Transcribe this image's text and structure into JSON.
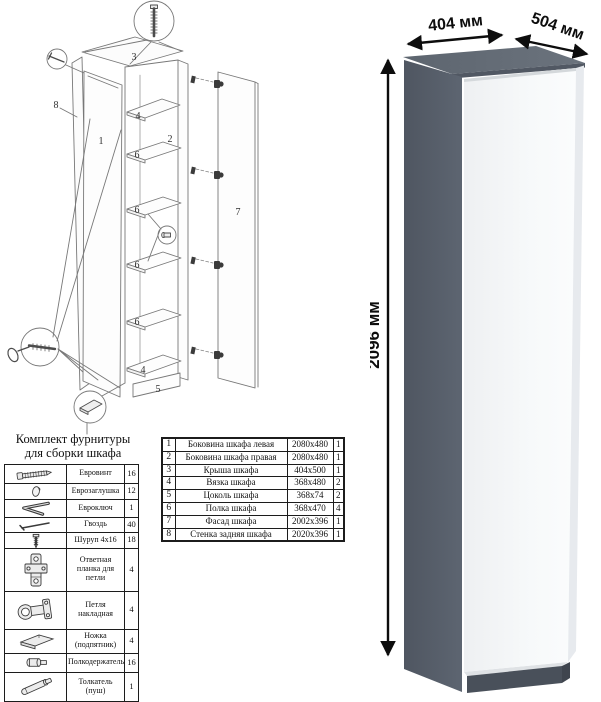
{
  "diagram": {
    "labels": {
      "left_side": "1",
      "right_side": "2",
      "roof": "3",
      "tie_top": "4",
      "tie_bottom": "4",
      "plinth": "5",
      "shelf_a": "6",
      "shelf_b": "6",
      "shelf_c": "6",
      "shelf_d": "6",
      "facade": "7",
      "back_panel": "8"
    }
  },
  "hardware": {
    "title_line1": "Комплект фурнитуры",
    "title_line2": "для сборки шкафа",
    "rows": [
      {
        "icon": "euroscrew-icon",
        "name": "Евровинт",
        "qty": "16"
      },
      {
        "icon": "eurocap-icon",
        "name": "Еврозаглушка",
        "qty": "12"
      },
      {
        "icon": "eurokey-icon",
        "name": "Евроключ",
        "qty": "1"
      },
      {
        "icon": "nail-icon",
        "name": "Гвоздь",
        "qty": "40"
      },
      {
        "icon": "screw-icon",
        "name": "Шуруп 4x16",
        "qty": "18"
      },
      {
        "icon": "hinge-plate-icon",
        "name": "Ответная планка для петли",
        "qty": "4"
      },
      {
        "icon": "hinge-icon",
        "name": "Петля накладная",
        "qty": "4"
      },
      {
        "icon": "foot-icon",
        "name": "Ножка (подпятник)",
        "qty": "4"
      },
      {
        "icon": "shelf-pin-icon",
        "name": "Полкодержатель",
        "qty": "16"
      },
      {
        "icon": "pusher-icon",
        "name": "Толкатель (пуш)",
        "qty": "1"
      }
    ]
  },
  "parts": {
    "rows": [
      {
        "num": "1",
        "name": "Боковина шкафа левая",
        "size": "2080x480",
        "qty": "1"
      },
      {
        "num": "2",
        "name": "Боковина шкафа правая",
        "size": "2080x480",
        "qty": "1"
      },
      {
        "num": "3",
        "name": "Крыша шкафа",
        "size": "404x500",
        "qty": "1"
      },
      {
        "num": "4",
        "name": "Вязка шкафа",
        "size": "368x480",
        "qty": "2"
      },
      {
        "num": "5",
        "name": "Цоколь шкафа",
        "size": "368x74",
        "qty": "2"
      },
      {
        "num": "6",
        "name": "Полка шкафа",
        "size": "368x470",
        "qty": "4"
      },
      {
        "num": "7",
        "name": "Фасад шкафа",
        "size": "2002x396",
        "qty": "1"
      },
      {
        "num": "8",
        "name": "Стенка задняя шкафа",
        "size": "2020x396",
        "qty": "1"
      }
    ]
  },
  "dimensions": {
    "width": "404 мм",
    "depth": "504 мм",
    "height": "2096 мм"
  },
  "colors": {
    "body_gray": "#59616d",
    "roof_gray": "#646c76",
    "plinth_gray": "#49505a",
    "facade_white": "#f6f8f9",
    "line_gray": "#787878",
    "dimension_black": "#0d0d0d"
  }
}
